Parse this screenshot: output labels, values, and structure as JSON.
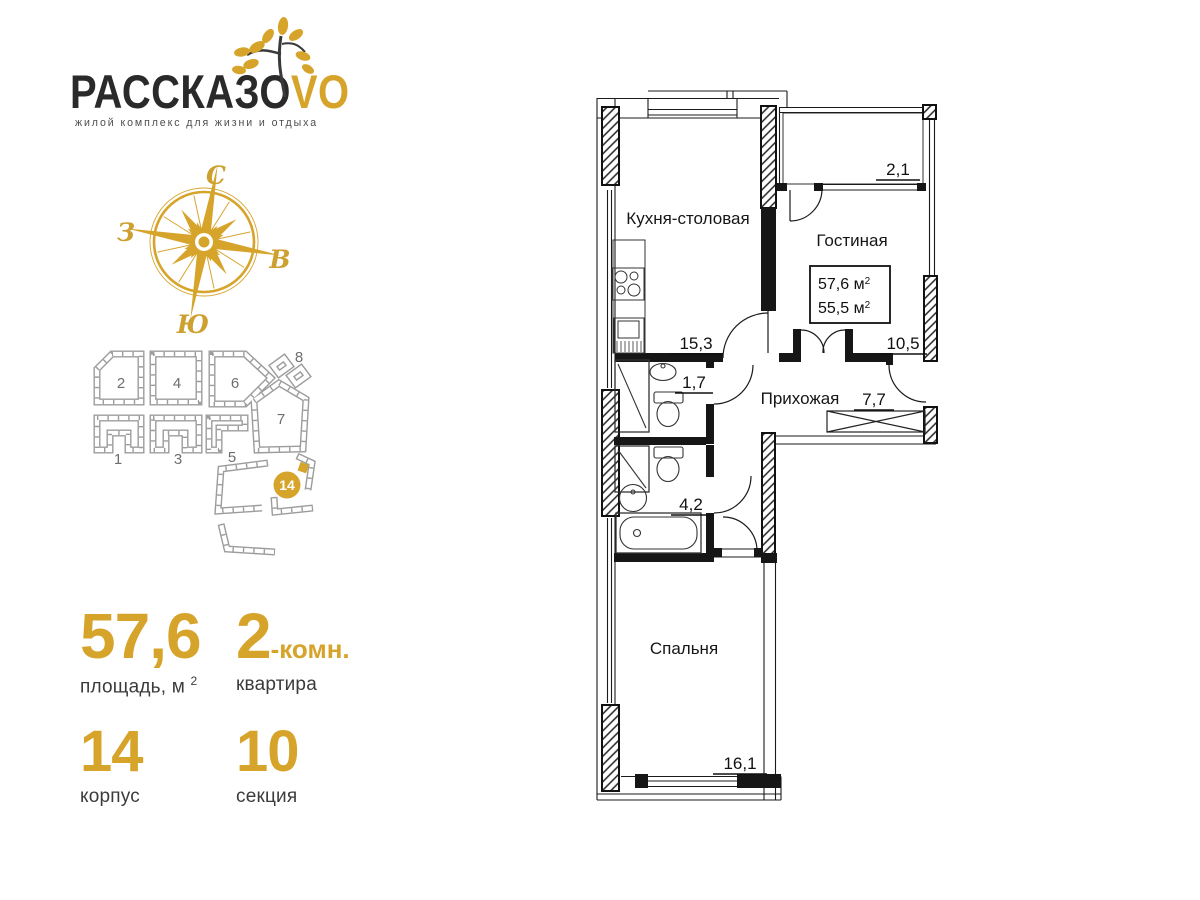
{
  "brand": {
    "wordmark": "РАССКАЗО",
    "wordmark_accent": "VO",
    "tagline": "жилой комплекс для жизни и отдыха"
  },
  "compass": {
    "north": "С",
    "east": "В",
    "south": "Ю",
    "west": "З"
  },
  "site_plan": {
    "building_labels": [
      "1",
      "2",
      "3",
      "4",
      "5",
      "6",
      "7",
      "8"
    ],
    "highlight_badge": "14"
  },
  "stats": {
    "area": {
      "value": "57,6",
      "label": "площадь, м",
      "label_sup": "2"
    },
    "rooms": {
      "value": "2",
      "suffix": "-комн.",
      "label": "квартира"
    },
    "building": {
      "value": "14",
      "label": "корпус"
    },
    "section": {
      "value": "10",
      "label": "секция"
    }
  },
  "floor_plan": {
    "rooms": {
      "kitchen": {
        "name": "Кухня-столовая",
        "area": "15,3"
      },
      "living": {
        "name": "Гостиная",
        "area": "10,5"
      },
      "hallway": {
        "name": "Прихожая",
        "area": "7,7"
      },
      "bedroom": {
        "name": "Спальня",
        "area": "16,1"
      },
      "wc": {
        "area": "1,7"
      },
      "bathroom": {
        "area": "4,2"
      },
      "balcony": {
        "area": "2,1"
      }
    },
    "summary": {
      "total_area": "57,6 м",
      "living_area": "55,5 м",
      "sup": "2"
    }
  },
  "colors": {
    "gold": "#D7A42B",
    "dark_text": "#3B3B3B",
    "plan_line": "#9C9C9C"
  }
}
